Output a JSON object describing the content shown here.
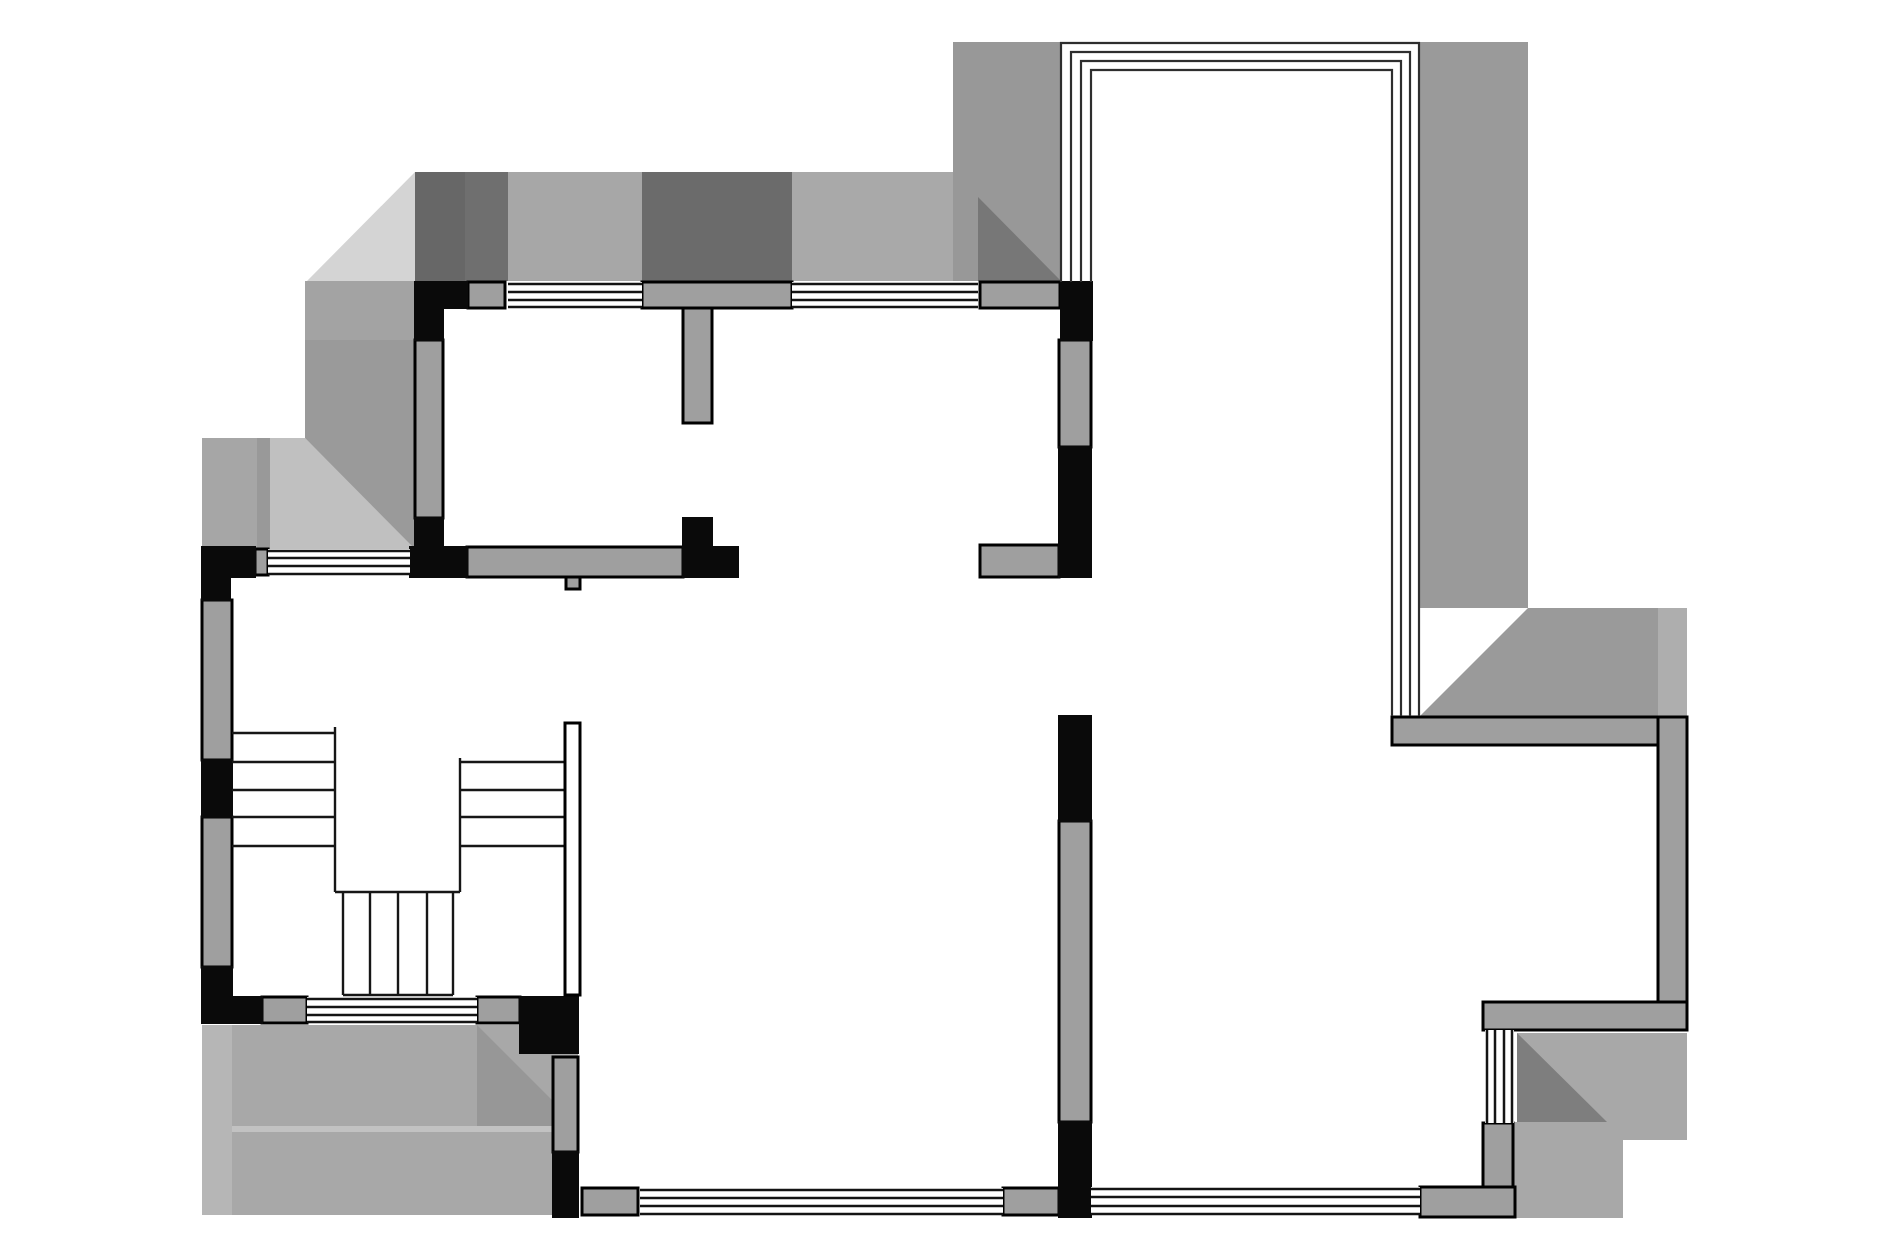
{
  "canvas": {
    "width": 1890,
    "height": 1260,
    "background": "#ffffff"
  },
  "palette": {
    "black_wall": "#0a0a0a",
    "gray_wall": "#9f9f9f",
    "wall_outline": "#000000",
    "window_line": "#141414",
    "frame_line": "#2e2e2e",
    "stair_line": "#161616",
    "white": "#ffffff"
  },
  "shading": [
    {
      "name": "shade-topleft-light-triangle",
      "shape": "polygon",
      "points": "307,281 415,172 415,281",
      "fill": "#d4d4d4"
    },
    {
      "name": "shade-top-dark-a",
      "shape": "rect",
      "x": 415,
      "y": 172,
      "w": 50,
      "h": 109,
      "fill": "#676767"
    },
    {
      "name": "shade-top-dark-b",
      "shape": "rect",
      "x": 465,
      "y": 172,
      "w": 43,
      "h": 109,
      "fill": "#6f6f6f"
    },
    {
      "name": "shade-top-mid-window1",
      "shape": "rect",
      "x": 508,
      "y": 172,
      "w": 134,
      "h": 109,
      "fill": "#a7a7a7"
    },
    {
      "name": "shade-top-dark-c",
      "shape": "rect",
      "x": 642,
      "y": 172,
      "w": 150,
      "h": 109,
      "fill": "#6b6b6b"
    },
    {
      "name": "shade-top-mid-window2",
      "shape": "polygon",
      "points": "792,172 953,172 953,197 978,197 978,281 792,281",
      "fill": "#a9a9a9"
    },
    {
      "name": "shade-balcony-left-band",
      "shape": "rect",
      "x": 953,
      "y": 42,
      "w": 108,
      "h": 239,
      "fill": "#989898"
    },
    {
      "name": "shade-mid-dark-triangle",
      "shape": "polygon",
      "points": "978,197 1061,281 978,281",
      "fill": "#777777"
    },
    {
      "name": "shade-topright-band",
      "shape": "rect",
      "x": 1420,
      "y": 42,
      "w": 108,
      "h": 566,
      "fill": "#9a9a9a"
    },
    {
      "name": "shade-topright-corner",
      "shape": "polygon",
      "points": "1420,716 1528,608 1687,608 1687,716",
      "fill": "#9a9a9a"
    },
    {
      "name": "shade-topright-seam",
      "shape": "rect",
      "x": 1658,
      "y": 608,
      "w": 29,
      "h": 108,
      "fill": "#aeaeae"
    },
    {
      "name": "shade-left-band-a",
      "shape": "rect",
      "x": 202,
      "y": 438,
      "w": 55,
      "h": 111,
      "fill": "#a6a6a6"
    },
    {
      "name": "shade-left-band-b",
      "shape": "rect",
      "x": 257,
      "y": 438,
      "w": 13,
      "h": 111,
      "fill": "#999999"
    },
    {
      "name": "shade-left-light-wedge",
      "shape": "polygon",
      "points": "270,438 305,438 417,549 270,549",
      "fill": "#c0c0c0"
    },
    {
      "name": "shade-left-col-upper",
      "shape": "rect",
      "x": 305,
      "y": 281,
      "w": 110,
      "h": 59,
      "fill": "#a3a3a3"
    },
    {
      "name": "shade-left-col-lower",
      "shape": "polygon",
      "points": "305,340 415,340 415,549 305,438",
      "fill": "#9a9a9a"
    },
    {
      "name": "shade-bottomleft-base",
      "shape": "rect",
      "x": 202,
      "y": 1025,
      "w": 376,
      "h": 190,
      "fill": "#a8a8a8"
    },
    {
      "name": "shade-bottomleft-light-col",
      "shape": "rect",
      "x": 202,
      "y": 1025,
      "w": 30,
      "h": 190,
      "fill": "#b6b6b6"
    },
    {
      "name": "shade-bottomleft-dark-wedge",
      "shape": "polygon",
      "points": "477,1025 578,1126 477,1126",
      "fill": "#979797"
    },
    {
      "name": "shade-bottomleft-seam",
      "shape": "rect",
      "x": 232,
      "y": 1126,
      "w": 321,
      "h": 6,
      "fill": "#c2c2c2"
    },
    {
      "name": "shade-bottomright-upper",
      "shape": "rect",
      "x": 1517,
      "y": 1033,
      "w": 170,
      "h": 107,
      "fill": "#a8a8a8"
    },
    {
      "name": "shade-bottomright-dark-triangle",
      "shape": "polygon",
      "points": "1517,1033 1607,1122 1517,1122",
      "fill": "#7e7e7e"
    },
    {
      "name": "shade-bottomright-lower",
      "shape": "rect",
      "x": 1513,
      "y": 1122,
      "w": 110,
      "h": 96,
      "fill": "#a8a8a8"
    }
  ],
  "gray_walls": [
    {
      "name": "wall-top-sill-left",
      "x": 468,
      "y": 282,
      "w": 37,
      "h": 26
    },
    {
      "name": "wall-top-mid",
      "x": 642,
      "y": 282,
      "w": 150,
      "h": 26
    },
    {
      "name": "wall-top-stub",
      "x": 683,
      "y": 308,
      "w": 29,
      "h": 115
    },
    {
      "name": "wall-top-sill-right",
      "x": 980,
      "y": 282,
      "w": 80,
      "h": 26
    },
    {
      "name": "wall-left-sill",
      "x": 255,
      "y": 549,
      "w": 13,
      "h": 26
    },
    {
      "name": "wall-room1-bottom",
      "x": 467,
      "y": 547,
      "w": 216,
      "h": 30
    },
    {
      "name": "wall-notch",
      "x": 566,
      "y": 577,
      "w": 14,
      "h": 12
    },
    {
      "name": "wall-stub-right",
      "x": 980,
      "y": 545,
      "w": 79,
      "h": 32
    },
    {
      "name": "wall-room1-left",
      "x": 415,
      "y": 340,
      "w": 28,
      "h": 178
    },
    {
      "name": "wall-left-upper",
      "x": 202,
      "y": 600,
      "w": 30,
      "h": 160
    },
    {
      "name": "wall-left-lower",
      "x": 202,
      "y": 817,
      "w": 30,
      "h": 150
    },
    {
      "name": "wall-mid-upper",
      "x": 1059,
      "y": 340,
      "w": 32,
      "h": 107
    },
    {
      "name": "wall-mid-long",
      "x": 1059,
      "y": 821,
      "w": 32,
      "h": 301
    },
    {
      "name": "wall-stair-col",
      "x": 553,
      "y": 1057,
      "w": 25,
      "h": 95
    },
    {
      "name": "wall-bottom-sill-a",
      "x": 582,
      "y": 1188,
      "w": 56,
      "h": 27
    },
    {
      "name": "wall-bottom-sill-b",
      "x": 1003,
      "y": 1188,
      "w": 56,
      "h": 27
    },
    {
      "name": "wall-stairs-sill-a",
      "x": 262,
      "y": 997,
      "w": 45,
      "h": 26
    },
    {
      "name": "wall-stairs-sill-b",
      "x": 477,
      "y": 997,
      "w": 43,
      "h": 26
    },
    {
      "name": "wall-balcony-bar",
      "x": 1392,
      "y": 717,
      "w": 268,
      "h": 28
    },
    {
      "name": "wall-right",
      "x": 1658,
      "y": 717,
      "w": 29,
      "h": 285
    },
    {
      "name": "wall-bottomright-bar",
      "x": 1483,
      "y": 1002,
      "w": 204,
      "h": 28
    },
    {
      "name": "wall-bottomright-corner-v",
      "x": 1483,
      "y": 1123,
      "w": 30,
      "h": 66
    },
    {
      "name": "wall-bottomright-corner-h",
      "x": 1420,
      "y": 1187,
      "w": 95,
      "h": 30
    }
  ],
  "black_walls": [
    {
      "name": "black-room1-corner-top-a",
      "x": 415,
      "y": 282,
      "w": 52,
      "h": 26
    },
    {
      "name": "black-room1-corner-top-b",
      "x": 415,
      "y": 300,
      "w": 28,
      "h": 40
    },
    {
      "name": "black-room1-left-lower",
      "x": 415,
      "y": 518,
      "w": 28,
      "h": 32
    },
    {
      "name": "black-room1-bottom",
      "x": 410,
      "y": 547,
      "w": 57,
      "h": 30
    },
    {
      "name": "black-top-tee-v",
      "x": 683,
      "y": 518,
      "w": 29,
      "h": 30
    },
    {
      "name": "black-top-tee-h",
      "x": 683,
      "y": 547,
      "w": 55,
      "h": 30
    },
    {
      "name": "black-balcony-left",
      "x": 1061,
      "y": 282,
      "w": 31,
      "h": 58
    },
    {
      "name": "black-mid-upper",
      "x": 1059,
      "y": 447,
      "w": 32,
      "h": 130
    },
    {
      "name": "black-mid-mid",
      "x": 1059,
      "y": 716,
      "w": 32,
      "h": 105
    },
    {
      "name": "black-mid-lower",
      "x": 1059,
      "y": 1122,
      "w": 32,
      "h": 95
    },
    {
      "name": "black-left-corner-a",
      "x": 202,
      "y": 547,
      "w": 53,
      "h": 30
    },
    {
      "name": "black-left-corner-b",
      "x": 202,
      "y": 577,
      "w": 28,
      "h": 23
    },
    {
      "name": "black-left-seg",
      "x": 202,
      "y": 760,
      "w": 30,
      "h": 57
    },
    {
      "name": "black-left-bottom-a",
      "x": 202,
      "y": 967,
      "w": 30,
      "h": 56
    },
    {
      "name": "black-left-bottom-b",
      "x": 232,
      "y": 997,
      "w": 30,
      "h": 26
    },
    {
      "name": "black-stairs-corner",
      "x": 520,
      "y": 997,
      "w": 58,
      "h": 56
    },
    {
      "name": "black-stair-col",
      "x": 553,
      "y": 1152,
      "w": 25,
      "h": 65
    }
  ],
  "windows": [
    {
      "name": "window-top-1",
      "band": [
        508,
        282,
        134,
        26
      ],
      "lines": [
        [
          508,
          284,
          642,
          284
        ],
        [
          508,
          292,
          642,
          292
        ],
        [
          508,
          300,
          642,
          300
        ],
        [
          508,
          307,
          642,
          307
        ]
      ]
    },
    {
      "name": "window-top-2",
      "band": [
        792,
        282,
        186,
        26
      ],
      "lines": [
        [
          792,
          284,
          978,
          284
        ],
        [
          792,
          292,
          978,
          292
        ],
        [
          792,
          300,
          978,
          300
        ],
        [
          792,
          307,
          978,
          307
        ]
      ]
    },
    {
      "name": "window-left-small",
      "band": [
        268,
        549,
        142,
        26
      ],
      "lines": [
        [
          268,
          551,
          410,
          551
        ],
        [
          268,
          558,
          410,
          558
        ],
        [
          268,
          566,
          410,
          566
        ],
        [
          268,
          574,
          410,
          574
        ]
      ]
    },
    {
      "name": "window-stairs-bottom",
      "band": [
        307,
        997,
        170,
        26
      ],
      "lines": [
        [
          307,
          999,
          477,
          999
        ],
        [
          307,
          1007,
          477,
          1007
        ],
        [
          307,
          1015,
          477,
          1015
        ],
        [
          307,
          1022,
          477,
          1022
        ]
      ]
    },
    {
      "name": "window-bottom-mid",
      "band": [
        640,
        1188,
        363,
        27
      ],
      "lines": [
        [
          640,
          1190,
          1003,
          1190
        ],
        [
          640,
          1198,
          1003,
          1198
        ],
        [
          640,
          1206,
          1003,
          1206
        ],
        [
          640,
          1214,
          1003,
          1214
        ]
      ]
    },
    {
      "name": "window-bottom-right",
      "band": [
        1091,
        1187,
        329,
        28
      ],
      "lines": [
        [
          1091,
          1189,
          1420,
          1189
        ],
        [
          1091,
          1197,
          1420,
          1197
        ],
        [
          1091,
          1206,
          1420,
          1206
        ],
        [
          1091,
          1214,
          1420,
          1214
        ]
      ]
    },
    {
      "name": "window-right-vertical",
      "band": [
        1485,
        1030,
        29,
        93
      ],
      "lines": [
        [
          1487,
          1030,
          1487,
          1123
        ],
        [
          1495,
          1030,
          1495,
          1123
        ],
        [
          1504,
          1030,
          1504,
          1123
        ],
        [
          1512,
          1030,
          1512,
          1123
        ]
      ]
    }
  ],
  "balcony_frame": [
    {
      "name": "balcony-frame-outer",
      "points": "1061,282 1061,43 1419,43 1419,716"
    },
    {
      "name": "balcony-frame-line2",
      "points": "1071,282 1071,52 1410,52 1410,716"
    },
    {
      "name": "balcony-frame-line3",
      "points": "1081,282 1081,61 1401,61 1401,716"
    },
    {
      "name": "balcony-frame-inner",
      "points": "1091,282 1091,70 1392,70 1392,716"
    }
  ],
  "stairs": {
    "rail": {
      "name": "stair-rail",
      "x": 565,
      "y": 723,
      "w": 15,
      "h": 272
    },
    "lines": [
      {
        "name": "stair-left-tread-1",
        "seg": [
          232,
          733,
          335,
          733
        ]
      },
      {
        "name": "stair-left-tread-2",
        "seg": [
          232,
          762,
          335,
          762
        ]
      },
      {
        "name": "stair-left-tread-3",
        "seg": [
          232,
          790,
          335,
          790
        ]
      },
      {
        "name": "stair-left-tread-4",
        "seg": [
          232,
          817,
          335,
          817
        ]
      },
      {
        "name": "stair-left-tread-5",
        "seg": [
          232,
          846,
          335,
          846
        ]
      },
      {
        "name": "stair-left-divider",
        "seg": [
          335,
          727,
          335,
          892
        ]
      },
      {
        "name": "stair-right-tread-1",
        "seg": [
          460,
          762,
          565,
          762
        ]
      },
      {
        "name": "stair-right-tread-2",
        "seg": [
          460,
          790,
          565,
          790
        ]
      },
      {
        "name": "stair-right-tread-3",
        "seg": [
          460,
          817,
          565,
          817
        ]
      },
      {
        "name": "stair-right-tread-4",
        "seg": [
          460,
          846,
          565,
          846
        ]
      },
      {
        "name": "stair-right-divider",
        "seg": [
          460,
          758,
          460,
          892
        ]
      },
      {
        "name": "stair-landing-bottom",
        "seg": [
          335,
          892,
          460,
          892
        ]
      },
      {
        "name": "stair-lower-flight-edge-1",
        "seg": [
          343,
          892,
          343,
          995
        ]
      },
      {
        "name": "stair-lower-flight-stripe-1",
        "seg": [
          370,
          892,
          370,
          995
        ]
      },
      {
        "name": "stair-lower-flight-stripe-2",
        "seg": [
          398,
          892,
          398,
          995
        ]
      },
      {
        "name": "stair-lower-flight-stripe-3",
        "seg": [
          427,
          892,
          427,
          995
        ]
      },
      {
        "name": "stair-lower-flight-edge-2",
        "seg": [
          453,
          892,
          453,
          995
        ]
      },
      {
        "name": "stair-lower-flight-bottom",
        "seg": [
          343,
          995,
          453,
          995
        ]
      }
    ]
  }
}
